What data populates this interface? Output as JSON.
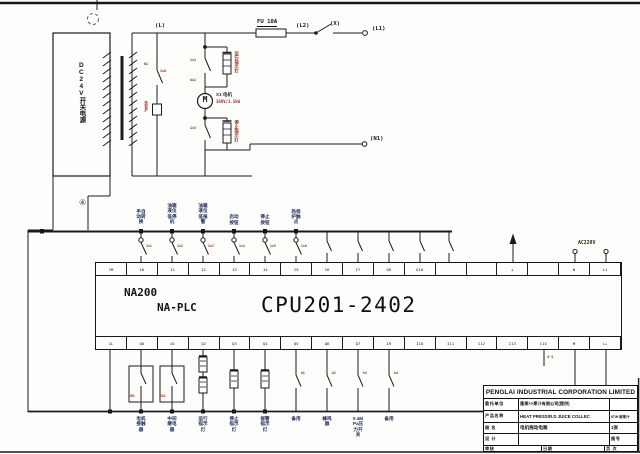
{
  "power": {
    "supply_label": "DC24V开关电源",
    "marker4": "④",
    "line_l": "(L)",
    "fuse": "FU 10A",
    "line_l2": "(L2)",
    "switch_x": "(X)",
    "line_l1": "(L1)",
    "line_n1": "(N1)",
    "tag_w1": "W1",
    "tag_1x0": "1x0",
    "tag_1x2": "1x2",
    "tag_ba1": "ba1",
    "tag_1x3": "1x3",
    "tag_prot": "热保护",
    "lamp_top": "运行指示灯",
    "lamp_bottom": "停止指示灯",
    "motor_symbol": "M",
    "motor_name": "X1 电机",
    "motor_rating": "380V/1.5kW",
    "misc_tag": "4-3"
  },
  "plc": {
    "brand": "NA200",
    "family": "NA-PLC",
    "cpu": "CPU201-2402",
    "ac_label": "AC220V",
    "top_terminals": [
      "1M",
      "I0",
      "I1",
      "I2",
      "I3",
      "I4",
      "I5",
      "I6",
      "I7",
      "Q9",
      "Q10",
      "",
      "",
      "⊥",
      "",
      "N",
      "L1"
    ],
    "bottom_terminals": [
      "1L",
      "Q0",
      "Q1",
      "Q2",
      "Q3",
      "Q4",
      "Q5",
      "Q6",
      "Q7",
      "I9",
      "I10",
      "I11",
      "I12",
      "I13",
      "I14",
      "M",
      "L+"
    ]
  },
  "inputs": [
    {
      "lines": [
        "手自",
        "动转",
        "换"
      ],
      "wire": "1x1"
    },
    {
      "lines": [
        "油箱",
        "液位",
        "低停",
        "机"
      ],
      "wire": "1x2"
    },
    {
      "lines": [
        "油箱",
        "液位",
        "低报",
        "警"
      ],
      "wire": "1x3"
    },
    {
      "lines": [
        "启动",
        "按钮"
      ],
      "wire": "1x4"
    },
    {
      "lines": [
        "停止",
        "按钮"
      ],
      "wire": "1x5"
    },
    {
      "lines": [
        "热保",
        "护触",
        "点"
      ],
      "wire": "1x6"
    }
  ],
  "outputs": [
    {
      "lines": [
        "电机",
        "接触",
        "器"
      ],
      "tag": "KM1"
    },
    {
      "lines": [
        "中间",
        "继电",
        "器"
      ],
      "tag": "KA1"
    },
    {
      "lines": [
        "运行",
        "指示",
        "灯"
      ]
    },
    {
      "lines": [
        "停止",
        "指示",
        "灯"
      ]
    },
    {
      "lines": [
        "报警",
        "指示",
        "灯"
      ]
    },
    {
      "lines": [
        "备用"
      ],
      "wire": "b1"
    },
    {
      "lines": [
        "蜂鸣",
        "器"
      ],
      "wire": "b2"
    },
    {
      "lines": [
        "0.4M",
        "Pa压",
        "力开",
        "关"
      ],
      "wire": "b3"
    },
    {
      "lines": [
        "备用"
      ],
      "wire": "b4"
    }
  ],
  "title_block": {
    "company": "PENGLAI INDUSTRIAL CORPORATION LIMITED",
    "r2_label": "委托单位",
    "r2_value": "蓬莱××果汁有限公司(提供)",
    "r3_label": "产品名称",
    "r3_value": "HEAT PRESS/R.D JUICE COLLEC",
    "r3_right": "6T/H 鲜果汁",
    "r4_label": "图  名",
    "r4_value": "电机拖动电路",
    "r4_right": "1张",
    "r5_label": "设  计",
    "r5_right": "图号",
    "r6_a": "审核",
    "r6_b": "日期",
    "r6_c": "页 次"
  }
}
